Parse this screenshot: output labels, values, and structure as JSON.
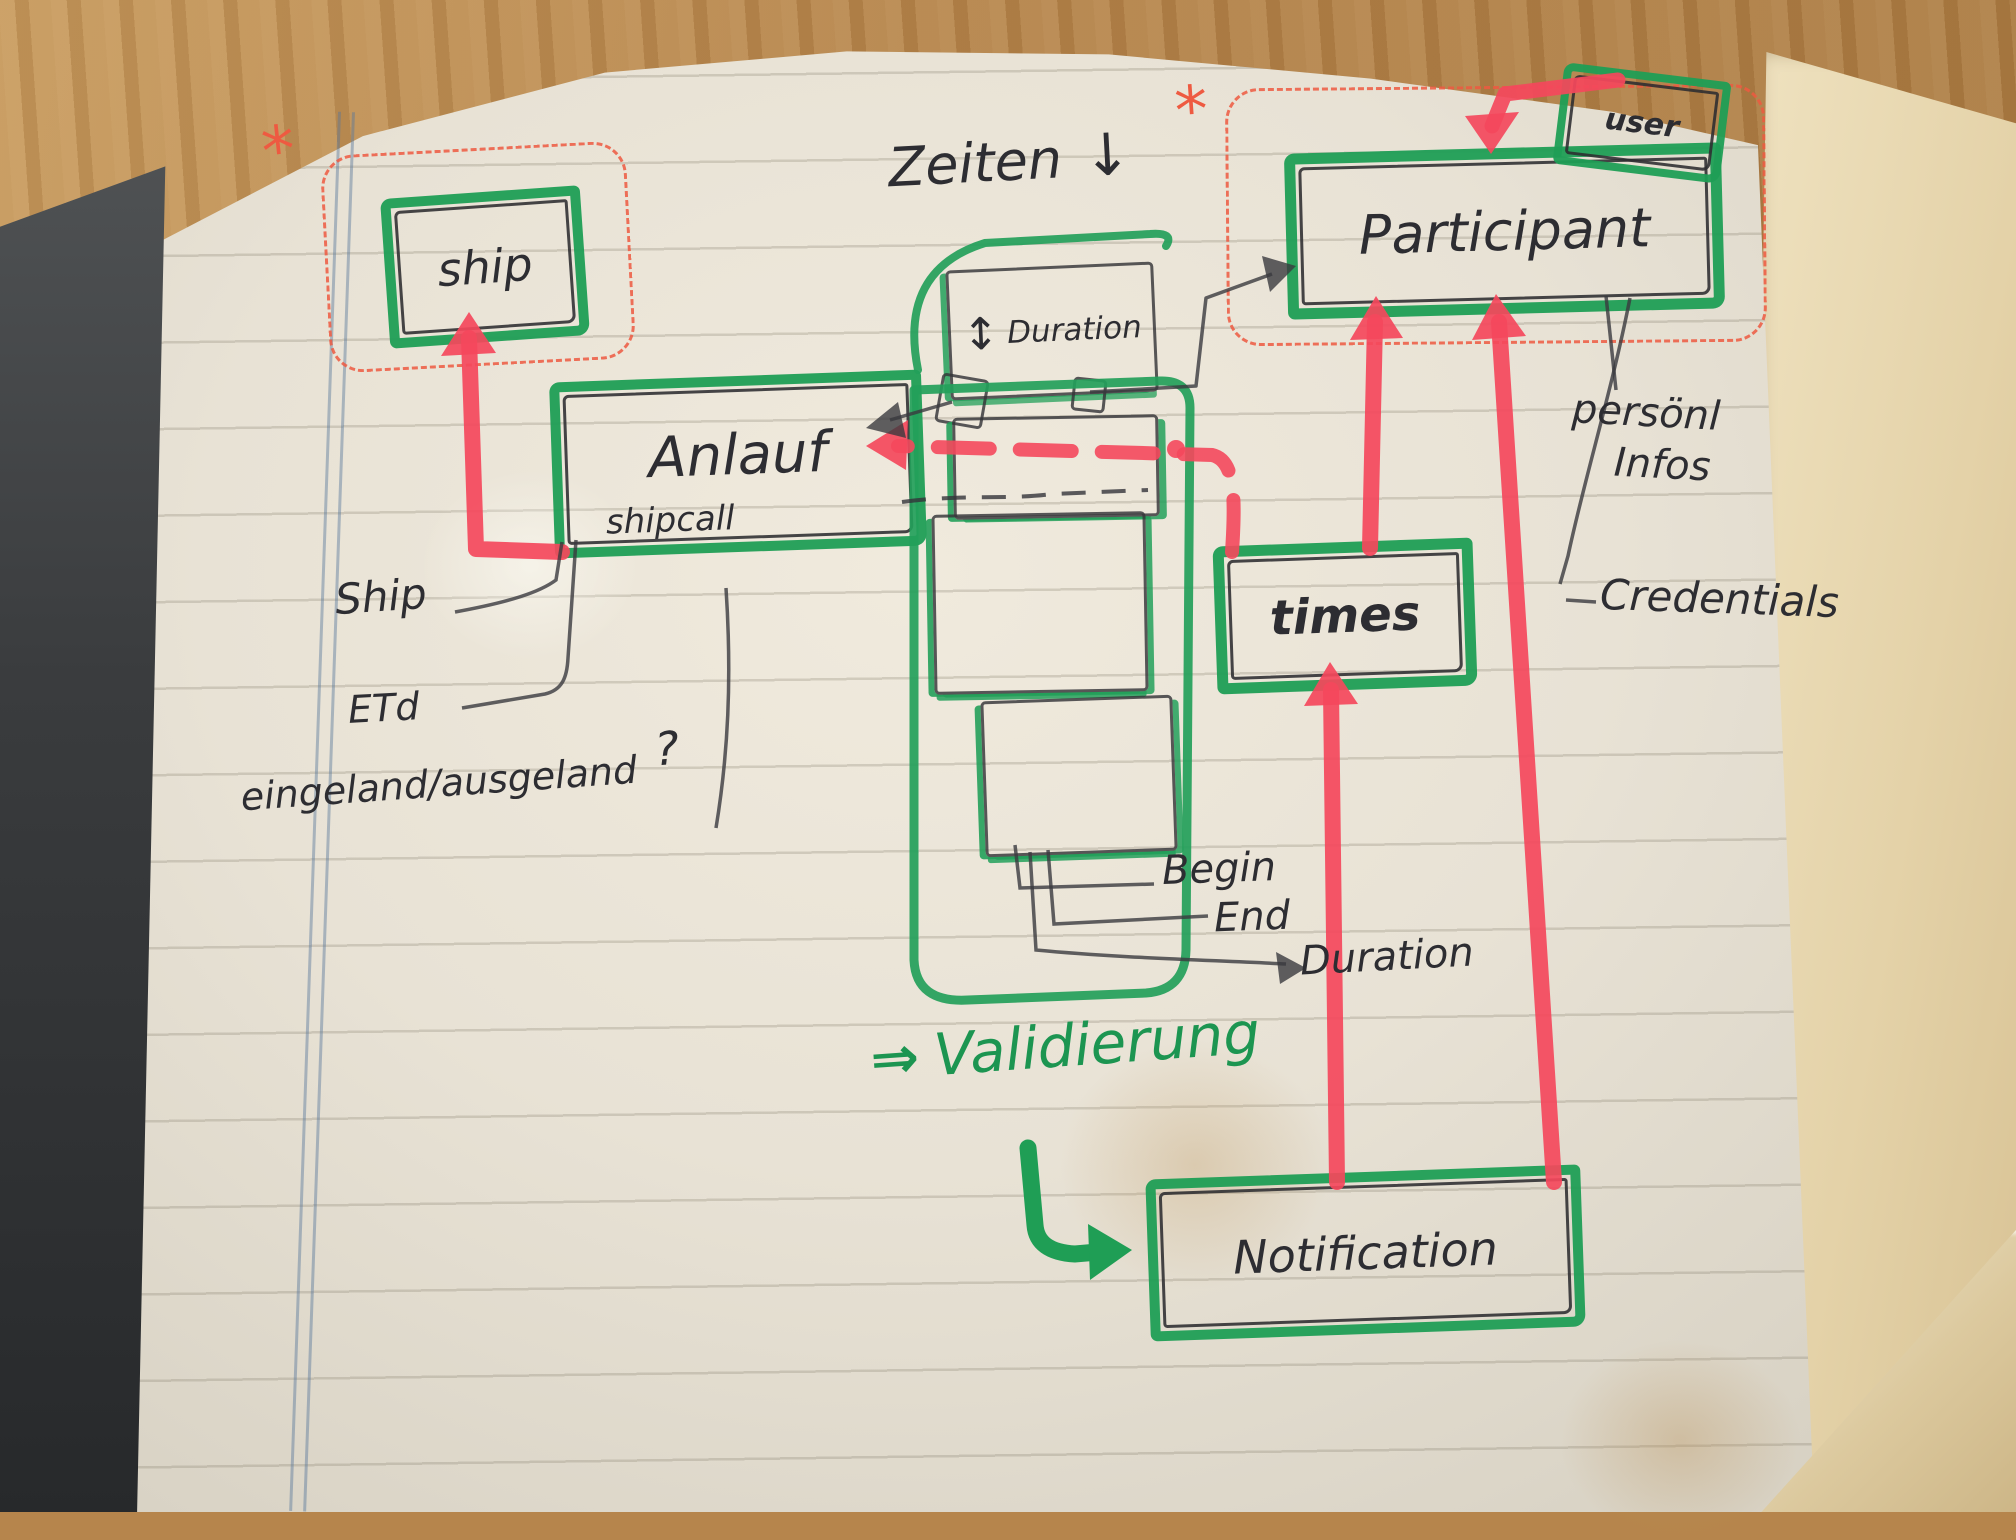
{
  "photo": {
    "description": "hand-drawn entity diagram sketched with green and red markers in a paper notebook",
    "colors": {
      "marker_green": "#1f9e55",
      "marker_red": "#f4485c",
      "pen_red_dashed": "#ee5a41",
      "ink": "#35353a",
      "paper": "#eae4d7"
    }
  },
  "diagram": {
    "annotations": {
      "zeiten_label": "Zeiten",
      "zeiten_arrow": "↓",
      "asterisk_ship": "*",
      "asterisk_participant": "*"
    },
    "nodes": {
      "ship": {
        "label": "ship"
      },
      "anlauf": {
        "label": "Anlauf",
        "sublabel": "shipcall"
      },
      "duration": {
        "updown_arrow": "↕",
        "label": "Duration"
      },
      "participant": {
        "label": "Participant"
      },
      "user": {
        "label": "user"
      },
      "times": {
        "label": "times"
      },
      "notification": {
        "label": "Notification"
      }
    },
    "attributes": {
      "ship_attr": "Ship",
      "eta_attr": "ETd",
      "inout_attr": "eingeland/ausgeland",
      "inout_question": "?",
      "personal_line1": "persönl",
      "personal_line2": "Infos",
      "credentials": "Credentials",
      "begin": "Begin",
      "end": "End",
      "duration_attr": "Duration"
    },
    "notes": {
      "validierung_arrow": "⇒",
      "validierung": "Validierung"
    }
  }
}
